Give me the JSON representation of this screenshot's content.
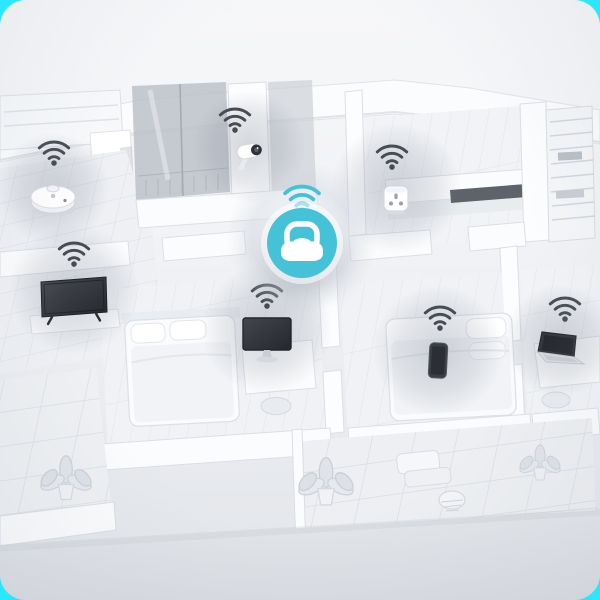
{
  "scene": {
    "name": "smart-home-wifi-coverage-illustration",
    "style": "isometric-3d-floorplan"
  },
  "colors": {
    "accent_teal": "#45c2d7",
    "corner_cyan": "#2ae7fc",
    "wifi_device_gray": "#474c53",
    "card_top": "#f6f7f9",
    "card_bottom": "#e2e5e9",
    "glass_gray": "#bcc1c9",
    "device_dark": "#35383e"
  },
  "router": {
    "name": "wifi-router"
  },
  "devices": [
    {
      "name": "robot-vacuum"
    },
    {
      "name": "security-camera"
    },
    {
      "name": "smart-plug"
    },
    {
      "name": "television"
    },
    {
      "name": "desktop-monitor"
    },
    {
      "name": "smartphone"
    },
    {
      "name": "laptop"
    }
  ]
}
